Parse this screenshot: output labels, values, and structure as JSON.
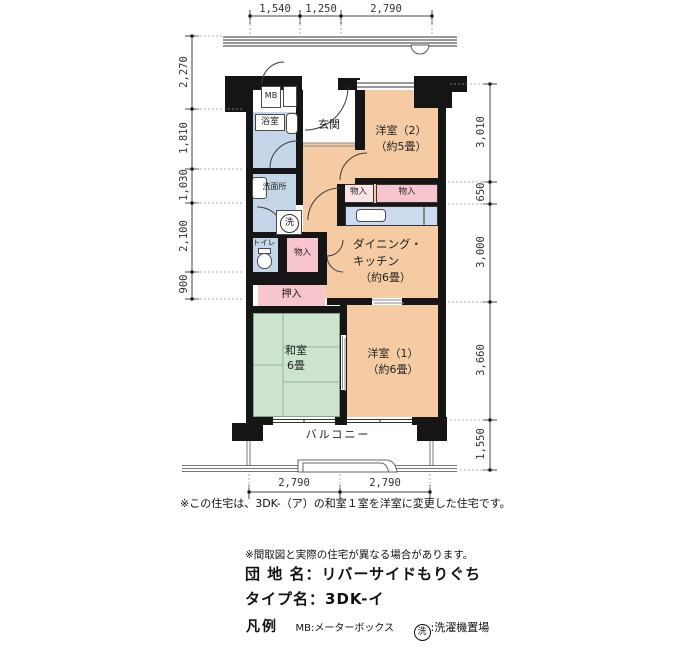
{
  "plan": {
    "rooms": {
      "mb": "MB",
      "bath": "浴室",
      "entrance": "玄関",
      "western2": "洋室（2）",
      "western2_size": "（約5畳）",
      "washroom": "洗面所",
      "wash_symbol": "洗",
      "storage1": "物入",
      "storage2": "物入",
      "storage3": "物入",
      "toilet": "トイレ",
      "dk_line1": "ダイニング・",
      "dk_line2": "キッチン",
      "dk_size": "（約6畳）",
      "closet": "押入",
      "japanese": "和室",
      "japanese_size": "6畳",
      "western1": "洋室（1）",
      "western1_size": "（約6畳）",
      "balcony": "バルコニー"
    },
    "dimensions": {
      "top": [
        "1,540",
        "1,250",
        "2,790"
      ],
      "left": [
        "2,270",
        "1,810",
        "1,030",
        "2,100",
        "900"
      ],
      "right": [
        "3,010",
        "650",
        "3,000",
        "3,660",
        "1,550"
      ],
      "bottom": [
        "2,790",
        "2,790"
      ]
    },
    "note": "※この住宅は、3DK-（ア）の和室１室を洋室に変更した住宅です。"
  },
  "info": {
    "disclaimer": "※間取図と実際の住宅が異なる場合があります。",
    "estate_label": "団 地 名：",
    "estate_name": "リバーサイドもりぐち",
    "type_label": "タイプ名：",
    "type_name": "3DK-イ",
    "legend_title": "凡例",
    "legend_mb": "MB:メーターボックス",
    "legend_wash_symbol": "洗",
    "legend_wash_label": ":洗濯機置場"
  },
  "colors": {
    "room_orange": "#f4cba2",
    "wet_blue": "#c5d6e8",
    "storage_pink": "#f6c5cd",
    "tatami_green": "#cde4cf",
    "counter_blue": "#ccdcee",
    "wall_black": "#151515"
  }
}
